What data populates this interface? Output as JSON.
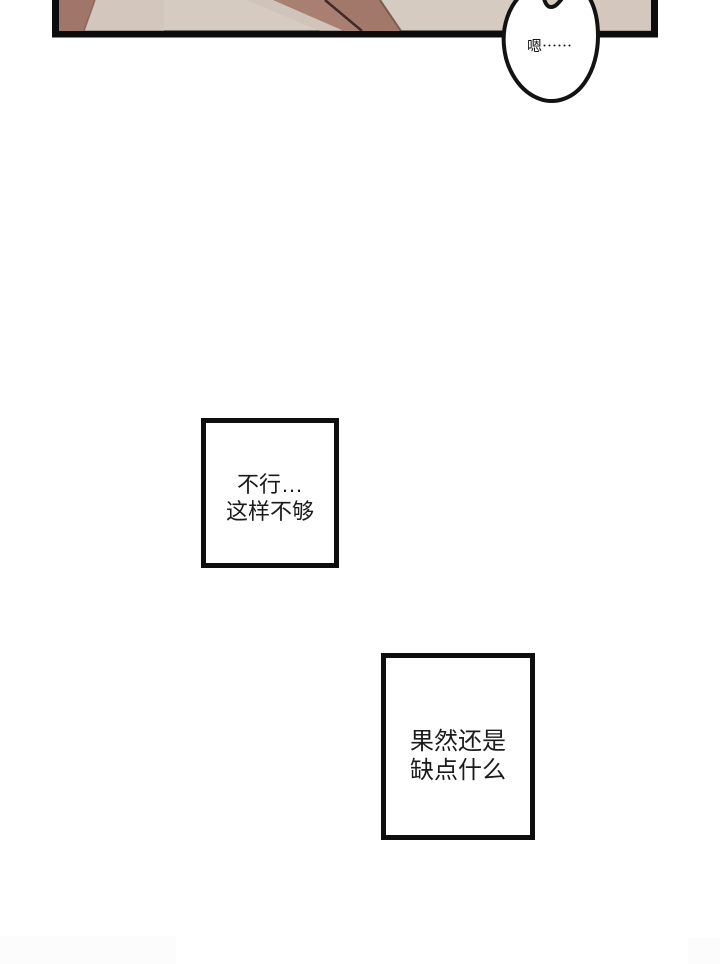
{
  "page": {
    "background": "#ffffff"
  },
  "top_panel": {
    "background": "#d6cbc1",
    "border_color": "#0d0d0d",
    "art_colors": {
      "left_arm": "#a1766a",
      "diagonal_band_left": "#a87f71",
      "diagonal_band_right": "#a2786a",
      "seam_line": "#3f2c25"
    }
  },
  "speech_bubble": {
    "text": "嗯⋯⋯",
    "fill": "#ffffff",
    "outline": "#131313"
  },
  "dialogue_boxes": [
    {
      "lines": [
        "不行…",
        "这样不够"
      ],
      "border": "#0f0f0f",
      "background": "#ffffff",
      "text_color": "#1b1b1b"
    },
    {
      "lines": [
        "果然还是",
        "缺点什么"
      ],
      "border": "#0f0f0f",
      "background": "#ffffff",
      "text_color": "#1b1b1b"
    }
  ]
}
